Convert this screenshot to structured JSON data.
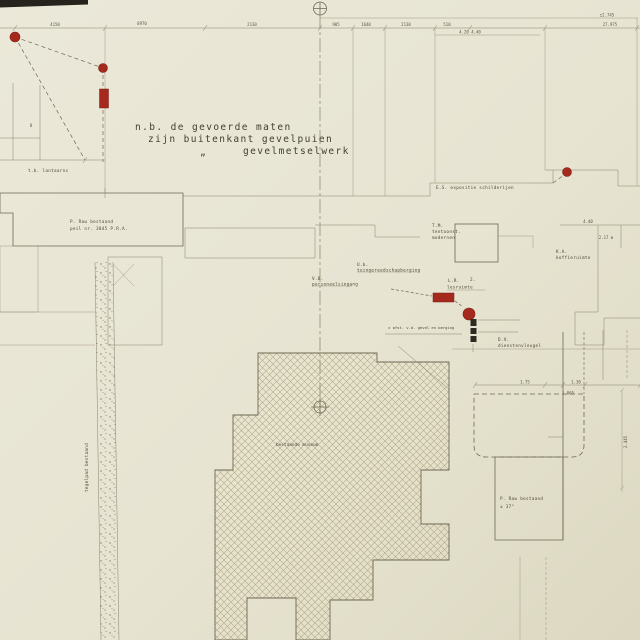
{
  "drawing": {
    "type": "architectural-site-plan",
    "language": "Dutch",
    "note": {
      "line1": "n.b. de gevoerde maten",
      "line2": "zijn buitenkant gevelpuien",
      "ditto": "„",
      "line3": "gevelmetselwerk"
    },
    "labels": {
      "es": "E.S. expositie schilderijen",
      "tm1": "T.M.",
      "tm2": "tentoonst.",
      "tm3": "modernen",
      "ka1": "K.A.",
      "ka2": "koffieruimte",
      "ub1": "U.b.",
      "ub2": "tuingereedschapberging",
      "vb1": "V.B.",
      "vb2": "personeelsingang",
      "lr1": "L.R.",
      "lr2": "lesruimte",
      "lr_num": "2.",
      "dv1": "D.V.",
      "dv2": "dienstenvleugel",
      "museum": "bestaande museum",
      "band1": "P. Raw bestaand",
      "band2": "peil nr. 3845 P.R.A.",
      "br1": "P. Raw bestaand",
      "br2": "± 37°",
      "tegelpad": "tegelpad bestaand",
      "topleft": "t.b. lantaarns",
      "erfnote": "± afst. v.d. gevel en berging"
    },
    "dims": {
      "d0": "4150",
      "d1": "8970",
      "d2": "2130",
      "d3": "905",
      "d4": "1640",
      "d5": "2130",
      "d6": "510",
      "d7": "27.975",
      "d8": "4.20  4.40",
      "d9": "±2.745",
      "d10": "8",
      "d11": "2.445",
      "d12": "4.40",
      "d13": "2.17 m",
      "d14": "1.75",
      "d15": "1.30",
      "d16": "1.065"
    },
    "markers": {
      "description": "red survey dots, red bars and black segmented bar markers",
      "red_dots": [
        [
          15,
          37
        ],
        [
          103,
          68
        ],
        [
          567,
          172
        ],
        [
          469,
          314
        ]
      ],
      "red_bars": [
        [
          99,
          89,
          9,
          19
        ],
        [
          433,
          293,
          21,
          9
        ]
      ],
      "black_bar": [
        470,
        318,
        6,
        26
      ]
    },
    "colors": {
      "paper": "#e9e6d5",
      "paper_dark": "#ded9c3",
      "ink": "#6f6852",
      "text": "#4f4a38",
      "red": "#a5291d",
      "black_marker": "#2e2a22",
      "hatch": "#aca377"
    }
  }
}
